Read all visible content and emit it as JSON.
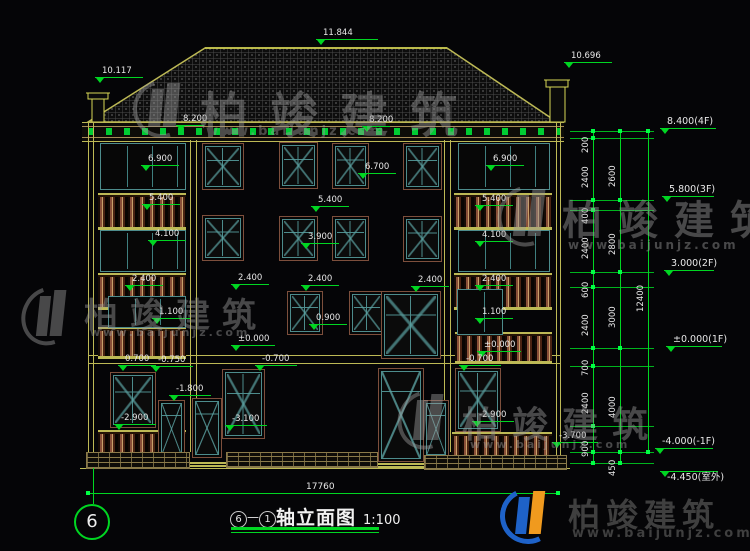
{
  "drawing": {
    "title": {
      "axis_start": "6",
      "axis_end": "1",
      "dash": "—",
      "name": "轴立面图",
      "scale": "1:100",
      "sheet_bubble": "6"
    },
    "total_width": "17760",
    "watermark": {
      "cn": "柏竣建筑",
      "url": "www.baijunjz.com"
    },
    "logo": {
      "cn": "柏竣建筑",
      "url": "www.baijunjz.com"
    },
    "colors": {
      "dim_green": "#00d622",
      "line_olive": "#bdb955",
      "frame_brown": "#7d4f3c",
      "sash_teal": "#4d8c8c",
      "chimney_yellow": "#d8d855"
    },
    "elevation_flags": [
      {
        "t": "11.844",
        "x": 316,
        "y": 28,
        "w": 62
      },
      {
        "t": "10.117",
        "x": 95,
        "y": 66,
        "w": 48
      },
      {
        "t": "10.696",
        "x": 564,
        "y": 51,
        "w": 48
      },
      {
        "t": "8.200",
        "x": 176,
        "y": 114,
        "w": 28
      },
      {
        "t": "8.200",
        "x": 362,
        "y": 115,
        "w": 28
      },
      {
        "t": "6.900",
        "x": 141,
        "y": 154
      },
      {
        "t": "6.700",
        "x": 358,
        "y": 162
      },
      {
        "t": "6.900",
        "x": 486,
        "y": 154
      },
      {
        "t": "5.400",
        "x": 142,
        "y": 193
      },
      {
        "t": "5.400",
        "x": 311,
        "y": 195
      },
      {
        "t": "5.400",
        "x": 475,
        "y": 194
      },
      {
        "t": "4.100",
        "x": 148,
        "y": 229
      },
      {
        "t": "4.100",
        "x": 475,
        "y": 230
      },
      {
        "t": "3.900",
        "x": 301,
        "y": 232
      },
      {
        "t": "2.400",
        "x": 125,
        "y": 274
      },
      {
        "t": "2.400",
        "x": 231,
        "y": 273
      },
      {
        "t": "2.400",
        "x": 301,
        "y": 274
      },
      {
        "t": "2.400",
        "x": 411,
        "y": 275
      },
      {
        "t": "2.400",
        "x": 475,
        "y": 274
      },
      {
        "t": "1.100",
        "x": 152,
        "y": 307
      },
      {
        "t": "1.100",
        "x": 475,
        "y": 307
      },
      {
        "t": "0.900",
        "x": 309,
        "y": 313
      },
      {
        "t": "±0.000",
        "x": 231,
        "y": 334,
        "w": 44
      },
      {
        "t": "±0.000",
        "x": 477,
        "y": 340,
        "w": 44
      },
      {
        "t": "0.700",
        "x": 118,
        "y": 354
      },
      {
        "t": "-0.750",
        "x": 151,
        "y": 355,
        "w": 42
      },
      {
        "t": "-0.700",
        "x": 255,
        "y": 354,
        "w": 42
      },
      {
        "t": "-0.700",
        "x": 459,
        "y": 354,
        "w": 42
      },
      {
        "t": "-1.800",
        "x": 169,
        "y": 384,
        "w": 42
      },
      {
        "t": "-2.900",
        "x": 114,
        "y": 413,
        "w": 42
      },
      {
        "t": "-2.900",
        "x": 472,
        "y": 410,
        "w": 42
      },
      {
        "t": "-3.100",
        "x": 225,
        "y": 414,
        "w": 42
      },
      {
        "t": "-3.700",
        "x": 552,
        "y": 431,
        "w": 46
      },
      {
        "t": "8.400(4F)",
        "x": 660,
        "y": 116,
        "w": 56,
        "big": 1
      },
      {
        "t": "5.800(3F)",
        "x": 662,
        "y": 184,
        "w": 52,
        "big": 1
      },
      {
        "t": "3.000(2F)",
        "x": 664,
        "y": 258,
        "w": 50,
        "big": 1
      },
      {
        "t": "±0.000(1F)",
        "x": 666,
        "y": 334,
        "w": 56,
        "big": 1
      },
      {
        "t": "-4.000(-1F)",
        "x": 655,
        "y": 436,
        "w": 58,
        "big": 1
      },
      {
        "t": "-4.450(室外)",
        "x": 660,
        "y": 470,
        "w": 58,
        "big": 1,
        "tb": 1
      }
    ],
    "dim_chains": {
      "levels": [
        131,
        138,
        200,
        210,
        272,
        287,
        348,
        366,
        426,
        452,
        463
      ],
      "inner": {
        "x": 593,
        "y1": 131,
        "y2": 463,
        "labels": [
          {
            "t": "200",
            "y": 134
          },
          {
            "t": "2400",
            "y": 169
          },
          {
            "t": "400",
            "y": 205
          },
          {
            "t": "2400",
            "y": 240
          },
          {
            "t": "600",
            "y": 279
          },
          {
            "t": "2400",
            "y": 317
          },
          {
            "t": "700",
            "y": 357
          },
          {
            "t": "2400",
            "y": 395
          },
          {
            "t": "900",
            "y": 438
          }
        ]
      },
      "middle": {
        "x": 620,
        "y1": 131,
        "y2": 463,
        "tickIdx": [
          0,
          2,
          4,
          6,
          9,
          10
        ],
        "labels": [
          {
            "t": "2600",
            "y": 168
          },
          {
            "t": "2800",
            "y": 236
          },
          {
            "t": "3000",
            "y": 309
          },
          {
            "t": "4000",
            "y": 399
          },
          {
            "t": "450",
            "y": 457
          }
        ]
      },
      "outer": {
        "x": 648,
        "y1": 131,
        "y2": 452,
        "tickIdx": [
          0,
          9
        ],
        "labels": [
          {
            "t": "12400",
            "y": 293
          }
        ]
      }
    }
  }
}
